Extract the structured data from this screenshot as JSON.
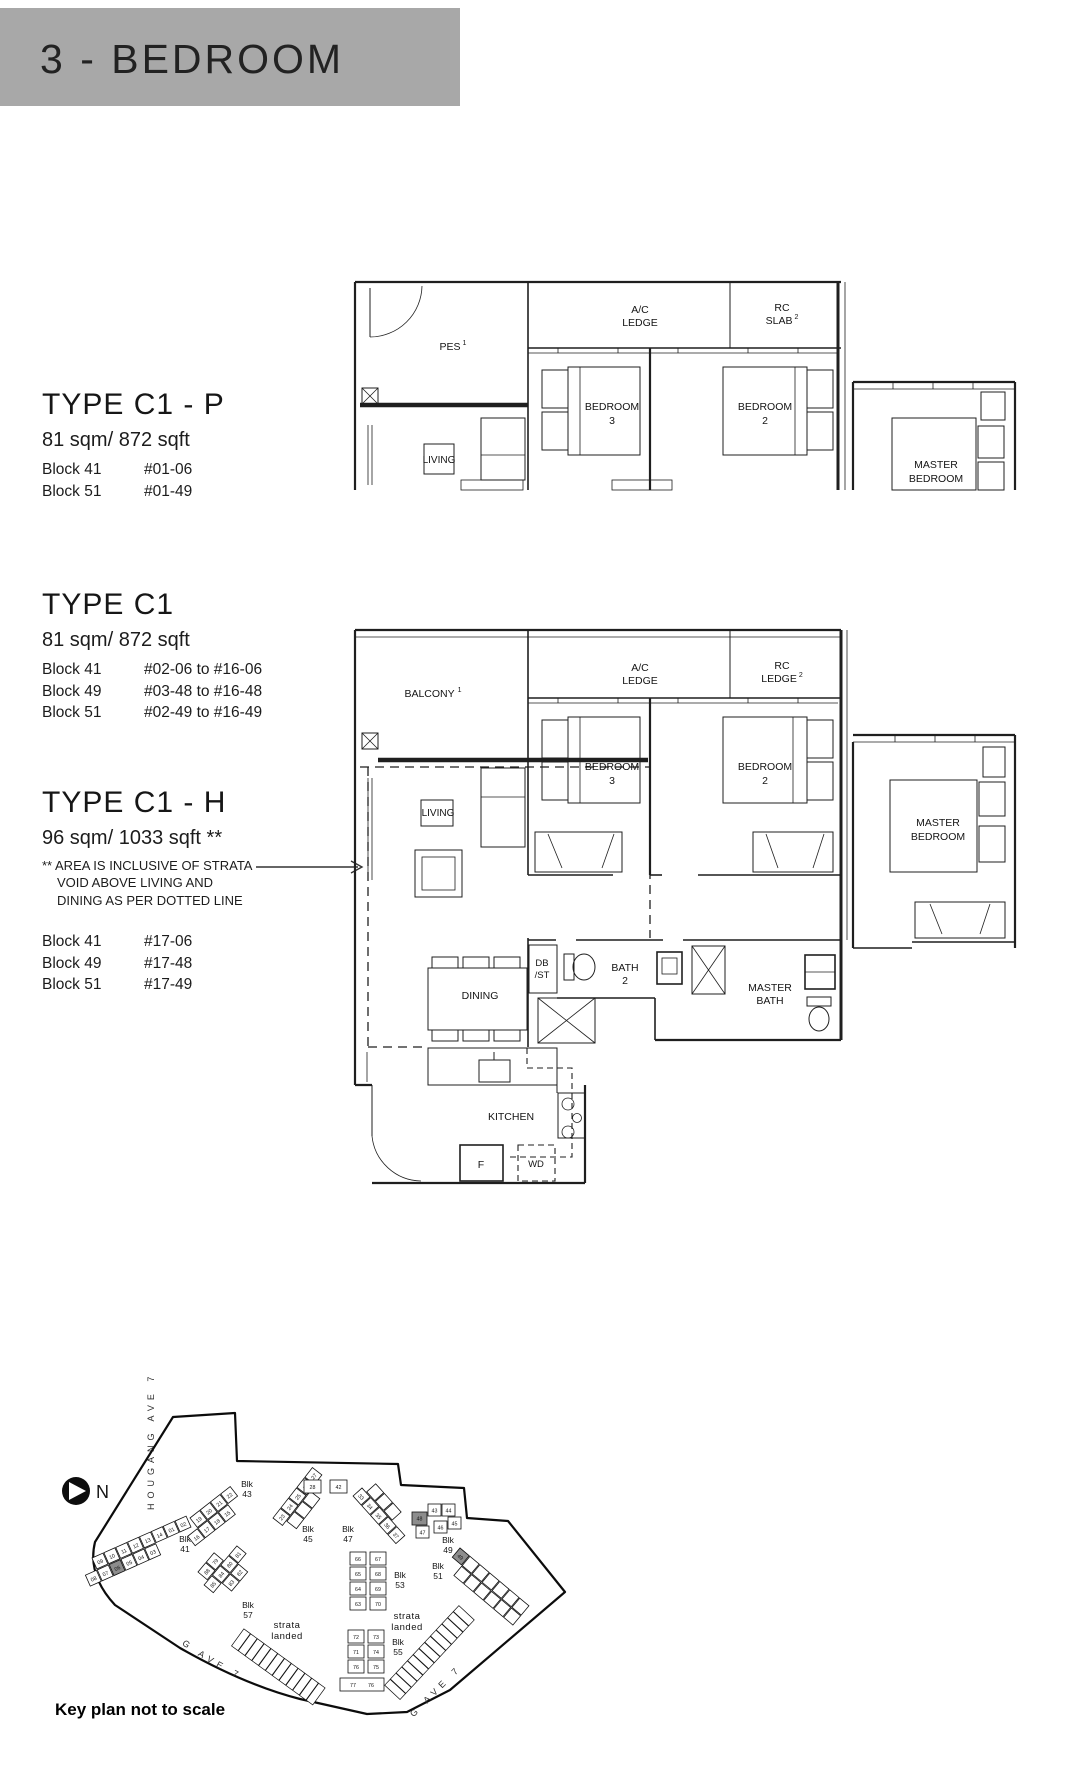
{
  "header": {
    "title": "3 - BEDROOM"
  },
  "types": [
    {
      "name": "TYPE C1 - P",
      "area": "81 sqm/ 872 sqft",
      "units": [
        {
          "block": "Block 41",
          "unit": "#01-06"
        },
        {
          "block": "Block 51",
          "unit": "#01-49"
        }
      ]
    },
    {
      "name": "TYPE C1",
      "area": "81 sqm/ 872 sqft",
      "units": [
        {
          "block": "Block 41",
          "unit": "#02-06 to #16-06"
        },
        {
          "block": "Block 49",
          "unit": "#03-48 to #16-48"
        },
        {
          "block": "Block 51",
          "unit": "#02-49 to #16-49"
        }
      ]
    },
    {
      "name": "TYPE C1 - H",
      "area": "96 sqm/ 1033 sqft **",
      "note": "** AREA IS INCLUSIVE OF STRATA VOID ABOVE LIVING AND DINING AS PER DOTTED LINE",
      "units": [
        {
          "block": "Block 41",
          "unit": "#17-06"
        },
        {
          "block": "Block 49",
          "unit": "#17-48"
        },
        {
          "block": "Block 51",
          "unit": "#17-49"
        }
      ]
    }
  ],
  "plan_top": {
    "labels": {
      "pes": "PES",
      "pes_sup": "1",
      "ac_l1": "A/C",
      "ac_l2": "LEDGE",
      "rc_l1": "RC",
      "rc_l2": "SLAB",
      "rc_sup": "2",
      "br3_l1": "BEDROOM",
      "br3_l2": "3",
      "br2_l1": "BEDROOM",
      "br2_l2": "2",
      "mbr_l1": "MASTER",
      "mbr_l2": "BEDROOM",
      "living": "LIVING"
    }
  },
  "plan_main": {
    "labels": {
      "balcony": "BALCONY",
      "balcony_sup": "1",
      "ac_l1": "A/C",
      "ac_l2": "LEDGE",
      "rc_l1": "RC",
      "rc_l2": "LEDGE",
      "rc_sup": "2",
      "br3_l1": "BEDROOM",
      "br3_l2": "3",
      "br2_l1": "BEDROOM",
      "br2_l2": "2",
      "mbr_l1": "MASTER",
      "mbr_l2": "BEDROOM",
      "living": "LIVING",
      "dining": "DINING",
      "db_l1": "DB",
      "db_l2": "/ST",
      "bath2_l1": "BATH",
      "bath2_l2": "2",
      "mbath_l1": "MASTER",
      "mbath_l2": "BATH",
      "kitchen": "KITCHEN",
      "fridge": "F",
      "wd": "WD"
    }
  },
  "keyplan": {
    "north": "N",
    "streets": {
      "left": "HOUGANG AVE 7",
      "bottom": "HOUGANG AVE 7",
      "right": "HOUGANG AVE 7"
    },
    "strata": {
      "l1": "strata",
      "l2": "landed"
    },
    "caption": "Key plan not to scale",
    "blocks": {
      "b41": {
        "l1": "Blk",
        "l2": "41"
      },
      "b43": {
        "l1": "Blk",
        "l2": "43"
      },
      "b45": {
        "l1": "Blk",
        "l2": "45"
      },
      "b47": {
        "l1": "Blk",
        "l2": "47"
      },
      "b49": {
        "l1": "Blk",
        "l2": "49"
      },
      "b51": {
        "l1": "Blk",
        "l2": "51"
      },
      "b53": {
        "l1": "Blk",
        "l2": "53"
      },
      "b55": {
        "l1": "Blk",
        "l2": "55"
      },
      "b57": {
        "l1": "Blk",
        "l2": "57"
      }
    },
    "units": {
      "b41": [
        "09",
        "10",
        "11",
        "12",
        "13",
        "14",
        "01",
        "02",
        "08",
        "07",
        "06",
        "05",
        "04",
        "03"
      ],
      "b43": [
        "19",
        "20",
        "21",
        "22",
        "16",
        "17",
        "18",
        "15"
      ],
      "b45": [
        "23",
        "24",
        "25",
        "26",
        "27"
      ],
      "b47": [
        "33",
        "34",
        "35",
        "36",
        "37"
      ],
      "mid": [
        "28",
        "42"
      ],
      "b49": [
        "48",
        "43",
        "44",
        "45",
        "46",
        "47"
      ],
      "b51": [
        "49"
      ],
      "b53": [
        "66",
        "67",
        "65",
        "68",
        "64",
        "69",
        "63",
        "70"
      ],
      "b55": [
        "72",
        "73",
        "71",
        "74",
        "76",
        "75",
        "77",
        "76"
      ],
      "b57": [
        "88",
        "79",
        "85",
        "84",
        "80",
        "81",
        "83",
        "82"
      ]
    },
    "highlighted": [
      "06",
      "48",
      "49"
    ]
  }
}
